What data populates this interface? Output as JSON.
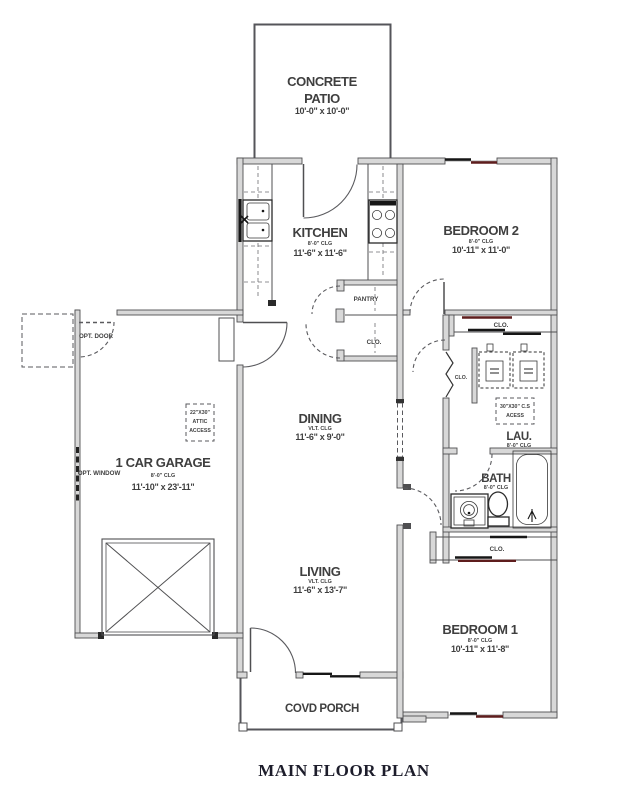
{
  "title": "MAIN FLOOR PLAN",
  "colors": {
    "wall": "#4f4f51",
    "accent": "#5e1d1d",
    "text": "#3f3f3f",
    "title": "#1d1d2b"
  },
  "rooms": {
    "patio": {
      "name_line1": "CONCRETE",
      "name_line2": "PATIO",
      "dims": "10'-0\" x 10'-0\""
    },
    "kitchen": {
      "name": "KITCHEN",
      "clg": "8'-0\" CLG",
      "dims": "11'-6\" x 11'-6\""
    },
    "bedroom2": {
      "name": "BEDROOM 2",
      "clg": "8'-0\" CLG",
      "dims": "10'-11\" x 11'-0\""
    },
    "garage": {
      "name": "1 CAR GARAGE",
      "clg": "8'-0\" CLG",
      "dims": "11'-10\" x 23'-11\""
    },
    "dining": {
      "name": "DINING",
      "clg": "VLT. CLG",
      "dims": "11'-6\" x 9'-0\""
    },
    "living": {
      "name": "LIVING",
      "clg": "VLT. CLG",
      "dims": "11'-6\" x 13'-7\""
    },
    "laundry": {
      "name": "LAU.",
      "clg": "8'-0\" CLG"
    },
    "bath": {
      "name": "BATH",
      "clg": "8'-0\" CLG"
    },
    "bedroom1": {
      "name": "BEDROOM 1",
      "clg": "8'-0\" CLG",
      "dims": "10'-11\" x 11'-8\""
    },
    "porch": {
      "name": "COVD PORCH"
    }
  },
  "annotations": {
    "pantry": "PANTRY",
    "closet_bed2": "CLO.",
    "closet_coat": "CLO.",
    "closet_linen": "CLO.",
    "closet_bed1": "CLO.",
    "opt_door": "OPT. DOOR",
    "opt_window": "OPT. WINDOW",
    "attic_access_line1": "22\"X30\"",
    "attic_access_line2": "ATTIC",
    "attic_access_line3": "ACCESS",
    "cs_access_line1": "30\"X30\" C.S",
    "cs_access_line2": "ACESS"
  }
}
